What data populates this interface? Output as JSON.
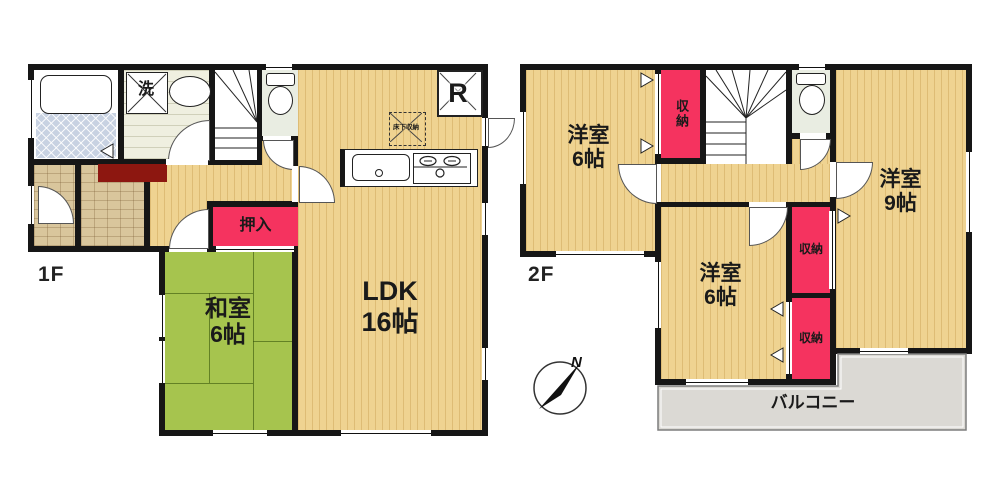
{
  "floor1": {
    "label": "1F",
    "ldk_name": "LDK",
    "ldk_size": "16帖",
    "washitsu_name": "和室",
    "washitsu_size": "6帖",
    "oshiire": "押入",
    "laundry": "洗",
    "refrigerator": "R",
    "underfloor_storage": "床下収納"
  },
  "floor2": {
    "label": "2F",
    "room_nw_name": "洋室",
    "room_nw_size": "6帖",
    "room_e_name": "洋室",
    "room_e_size": "9帖",
    "room_s_name": "洋室",
    "room_s_size": "6帖",
    "closet_top": "収納",
    "closet_mid": "収納",
    "closet_bottom": "収納",
    "balcony": "バルコニー"
  },
  "compass": {
    "north_label": "N"
  },
  "colors": {
    "wall": "#161616",
    "wood_floor": "#EFD391",
    "tatami_green": "#A6C44E",
    "closet_pink": "#F5335F",
    "entrance_stone": "#D9C69C",
    "bath_tile": "#C8D2E2",
    "mat_dark_red": "#8D1710",
    "balcony_gray": "#DBD9D4"
  }
}
